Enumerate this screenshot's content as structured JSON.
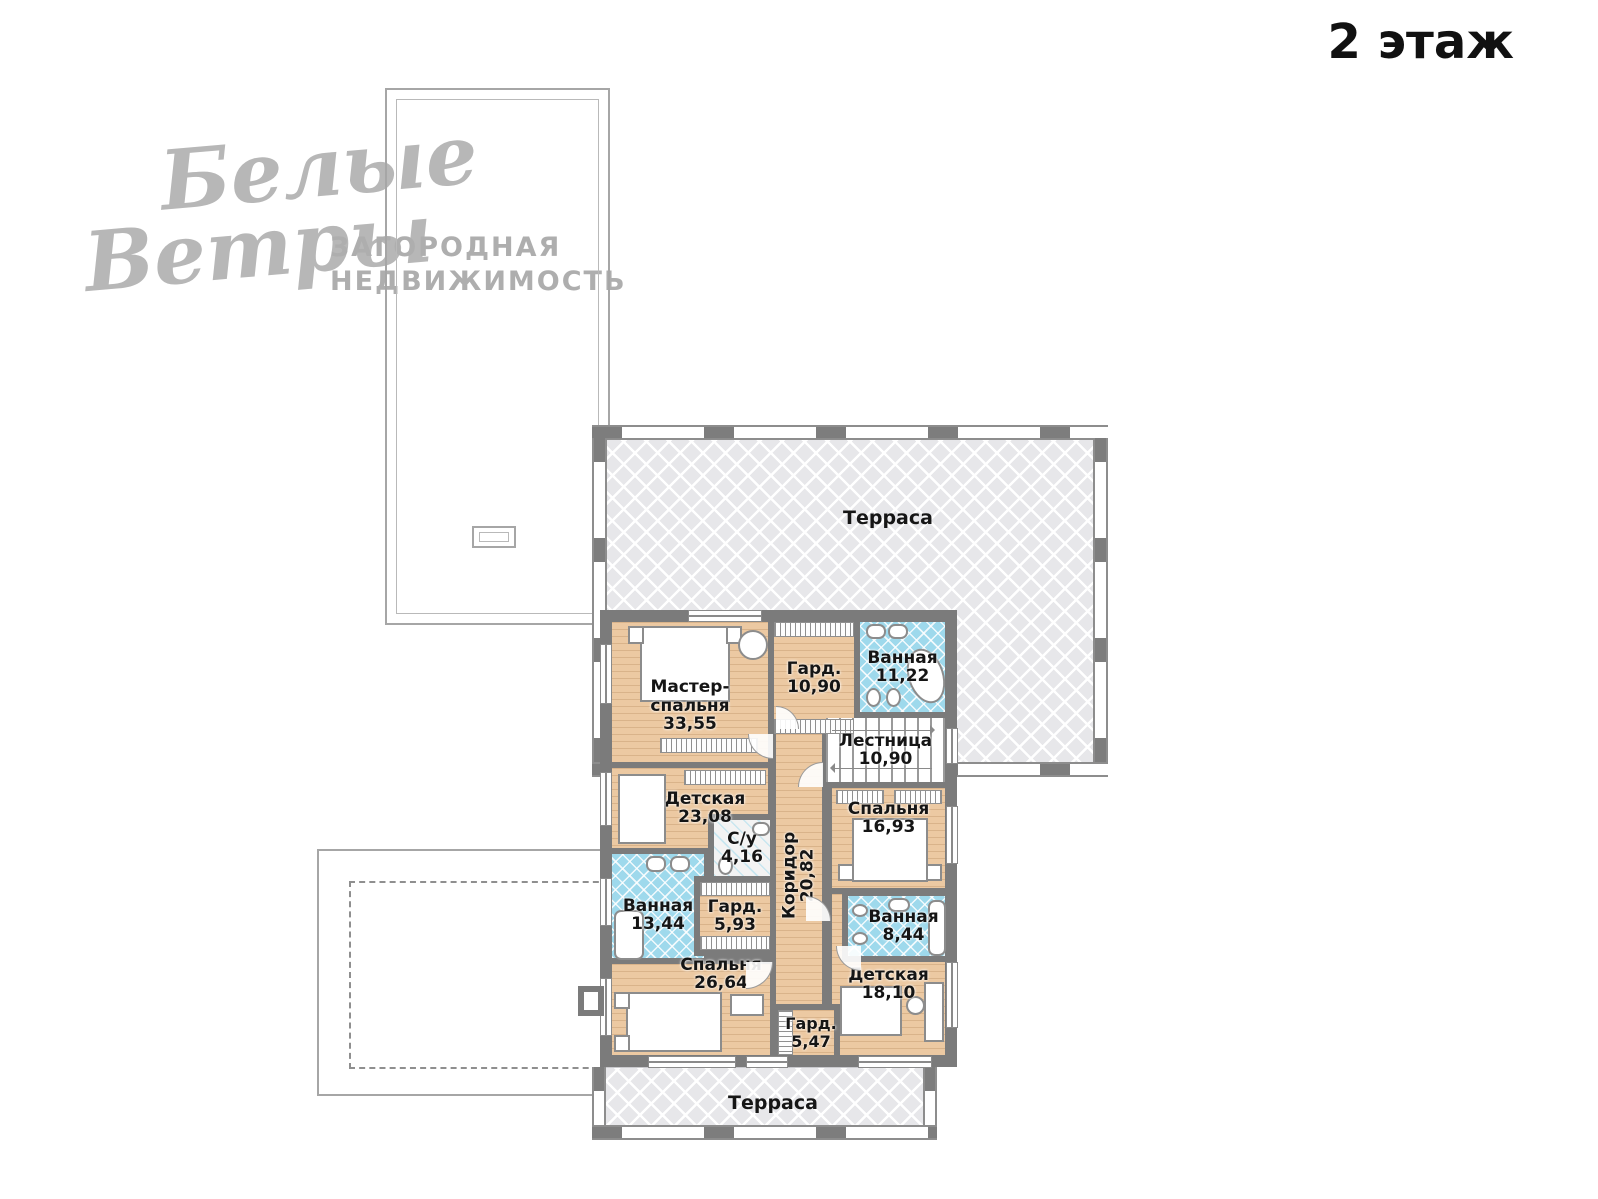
{
  "page": {
    "title": "2 этаж"
  },
  "watermark": {
    "script1": "Белые",
    "script2": "Ветры",
    "sub1": "ЗАГОРОДНАЯ",
    "sub2": "НЕДВИЖИМОСТЬ"
  },
  "floor_plan": {
    "terraces": [
      {
        "label": "Терраса"
      },
      {
        "label": "Терраса"
      }
    ],
    "rooms": [
      {
        "id": "master-bedroom",
        "label": "Мастер-спальня",
        "area": "33,55"
      },
      {
        "id": "wardrobe-1",
        "label": "Гард.",
        "area": "10,90"
      },
      {
        "id": "bathroom-1",
        "label": "Ванная",
        "area": "11,22"
      },
      {
        "id": "stairs",
        "label": "Лестница",
        "area": "10,90"
      },
      {
        "id": "corridor",
        "label": "Коридор",
        "area": "20,82"
      },
      {
        "id": "kids-room-1",
        "label": "Детская",
        "area": "23,08"
      },
      {
        "id": "bedroom-1",
        "label": "Спальня",
        "area": "16,93"
      },
      {
        "id": "wc",
        "label": "С/у",
        "area": "4,16"
      },
      {
        "id": "wardrobe-2",
        "label": "Гард.",
        "area": "5,93"
      },
      {
        "id": "bathroom-2",
        "label": "Ванная",
        "area": "13,44"
      },
      {
        "id": "bathroom-3",
        "label": "Ванная",
        "area": "8,44"
      },
      {
        "id": "bedroom-2",
        "label": "Спальня",
        "area": "26,64"
      },
      {
        "id": "kids-room-2",
        "label": "Детская",
        "area": "18,10"
      },
      {
        "id": "wardrobe-3",
        "label": "Гард.",
        "area": "5,47"
      }
    ],
    "colors": {
      "wall": "#7b7b7b",
      "wood_floor": "#ecc9a2",
      "tile": "#9ed9ec",
      "terrace": "#e7e7ea",
      "label_text": "#151515",
      "watermark": "#b7b7b7"
    }
  }
}
